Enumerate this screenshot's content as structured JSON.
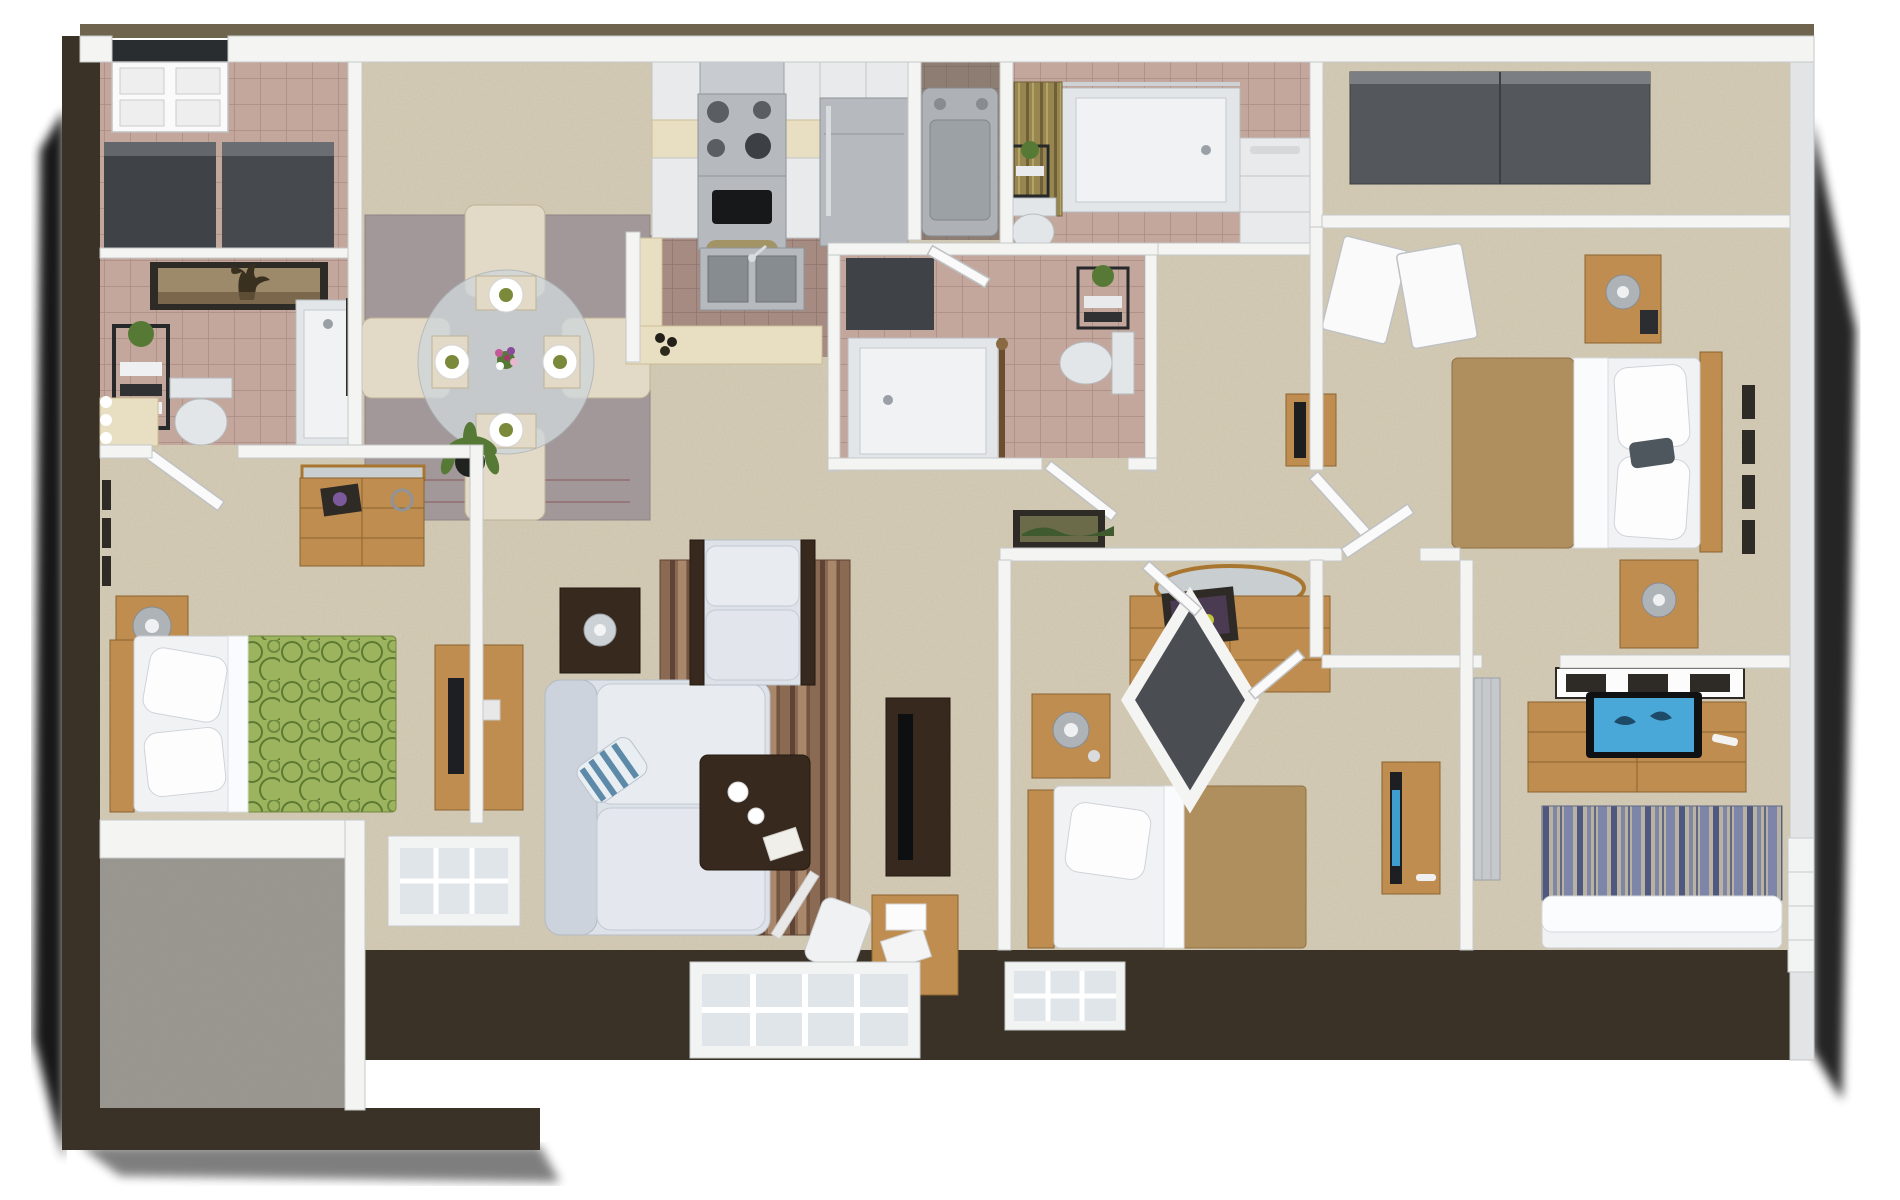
{
  "meta": {
    "kind": "3d-isometric-floor-plan-render",
    "description": "Dollhouse-view 3D rendering of a multi-bedroom apartment; no text labels visible in the image"
  },
  "palette": {
    "page_bg": "#ffffff",
    "exterior": "#3a3127",
    "exterior_top": "#6f654e",
    "wall_white": "#f4f4f3",
    "carpet": "#d5ccb6",
    "carpet_patio": "#9b9891",
    "tile_pink": "#c3a69c",
    "tile_brown": "#a68b82",
    "tile_laundry": "#8d7d72",
    "rug_dining": "#a29899",
    "rug_stripe_dark": "#5f4334",
    "rug_stripe_mid": "#8a6a52",
    "rug_stripe_light": "#a8876b",
    "wood_light": "#c08d51",
    "wood_dark": "#38291f",
    "sofa": "#dde1e8",
    "bed_white": "#f1f2f4",
    "bed_tan": "#b08f5e",
    "bed_green": "#9cb45e",
    "bed_green_pattern": "#5d7a33",
    "bed_stripe_blue": "#7d86a8",
    "bed_stripe_navy": "#4f587e",
    "bed_stripe_tan": "#b9b2a2",
    "stainless": "#b6babf",
    "appliance_gray": "#aeb2b6",
    "curtain_gold": "#97864f",
    "plant_green": "#567a36",
    "closet_dark": "#4a4e53",
    "tv_screen_blue": "#49a8d8",
    "frame_dark": "#2e2a26",
    "edge_shadow": "#000000"
  },
  "rooms": [
    {
      "id": "entry-foyer",
      "furnishings": [
        "entry-double-door",
        "hall-closet",
        "hall-closet"
      ]
    },
    {
      "id": "bathroom-left",
      "furnishings": [
        "framed-tree-art",
        "plant-etagere",
        "toilet",
        "bathtub",
        "lighted-vanity-mirror"
      ]
    },
    {
      "id": "bedroom-green",
      "furnishings": [
        "bed-green-circle-bedspread",
        "headboard",
        "nightstand",
        "table-lamp",
        "dresser-with-mirror",
        "wall-art-trio",
        "open-door"
      ]
    },
    {
      "id": "patio-storage",
      "furnishings": [
        "sliding-glass-door"
      ]
    },
    {
      "id": "dining-area",
      "furnishings": [
        "area-rug",
        "round-glass-table",
        "dining-chair",
        "dining-chair",
        "dining-chair",
        "dining-chair",
        "place-setting",
        "place-setting",
        "place-setting",
        "place-setting",
        "flower-centerpiece",
        "framed-art",
        "framed-art",
        "green-framed-art"
      ]
    },
    {
      "id": "kitchen",
      "furnishings": [
        "upper-cabinets",
        "range-hood",
        "stove-with-oven",
        "refrigerator",
        "lower-cabinets",
        "breakfast-bar",
        "double-sink",
        "bottles"
      ]
    },
    {
      "id": "laundry-closet",
      "furnishings": [
        "washer-dryer"
      ]
    },
    {
      "id": "bathroom-gold",
      "furnishings": [
        "gold-shower-curtain",
        "bathtub",
        "toilet",
        "plant-etagere",
        "lighted-vanity-mirror",
        "vanity-cabinets"
      ]
    },
    {
      "id": "walk-in-closet",
      "furnishings": [
        "sliding-wardrobe-doors"
      ]
    },
    {
      "id": "master-bedroom",
      "furnishings": [
        "bed-tan-bedspread",
        "headboard",
        "nightstand",
        "nightstand",
        "table-lamp",
        "table-lamp",
        "closet-door-panels",
        "wall-art-column",
        "accent-pillow"
      ]
    },
    {
      "id": "bathroom-center",
      "furnishings": [
        "linen-closet",
        "bathtub",
        "shower-rod",
        "toilet",
        "plant-etagere",
        "open-door"
      ]
    },
    {
      "id": "hallway",
      "furnishings": [
        "framed-landscape-art",
        "console-table-with-mirror"
      ]
    },
    {
      "id": "bedroom-tan",
      "furnishings": [
        "bed-tan-bedspread",
        "headboard",
        "nightstand",
        "table-lamp",
        "dresser-with-oval-mirror",
        "framed-flower-art",
        "tv-console"
      ]
    },
    {
      "id": "bedroom-striped",
      "furnishings": [
        "bed-striped-bedspread",
        "dresser-with-tv",
        "tv-dolphin-screen",
        "remote-control",
        "wall-art-gallery",
        "mirrored-closet-door",
        "window"
      ]
    },
    {
      "id": "living-room",
      "furnishings": [
        "sofa",
        "striped-accent-pillow",
        "armchair",
        "striped-area-rug",
        "coffee-table",
        "bowl",
        "bowl",
        "magazine",
        "media-console",
        "flat-tv",
        "end-table",
        "chrome-lamp",
        "potted-plant",
        "tv-stand-with-monitor",
        "desk",
        "laptop",
        "desk-chair"
      ]
    },
    {
      "id": "center-closets",
      "furnishings": [
        "angled-closet-doors"
      ]
    }
  ],
  "windows": [
    "living-room-bottom-window",
    "bedroom-tan-bottom-window",
    "bedroom-striped-right-window",
    "bedroom-green-bay-window"
  ],
  "doors": [
    "entry-double-door",
    "patio-sliding-door",
    "bedroom-green-door",
    "bathroom-center-door",
    "master-door",
    "bedroom-tan-door",
    "bedroom-striped-door"
  ]
}
